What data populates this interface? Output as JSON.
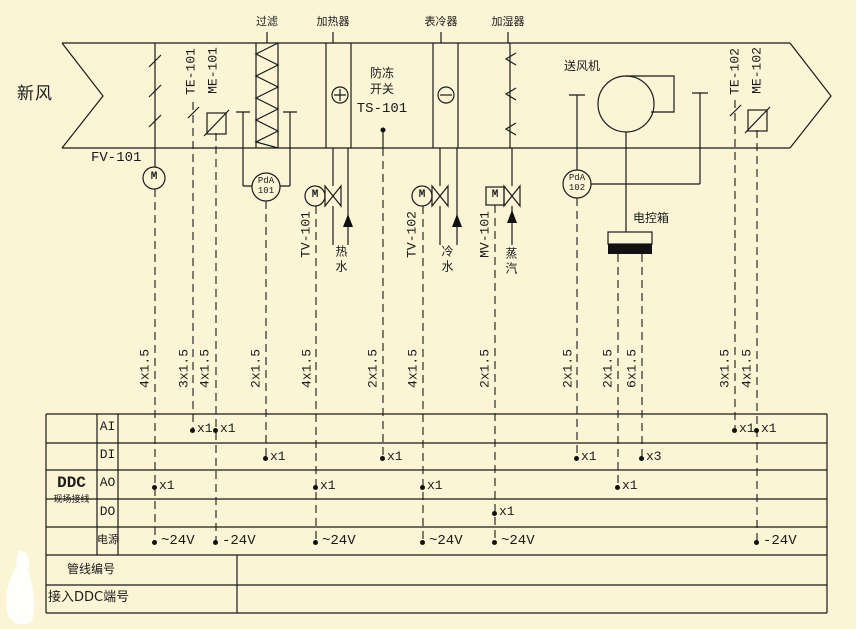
{
  "colors": {
    "background": "#FBF5D6",
    "ink": "#1b1b1b",
    "box_fill": "#111111",
    "blob": "#FEFEFB"
  },
  "duct": {
    "inlet_label": "新风",
    "fan_label": "送风机",
    "sections": [
      {
        "label": "过滤",
        "x": 267
      },
      {
        "label": "加热器",
        "x": 333
      },
      {
        "label": "表冷器",
        "x": 441
      },
      {
        "label": "加湿器",
        "x": 508
      }
    ]
  },
  "devices": {
    "damper_label": "FV-101",
    "control_box_label": "电控箱",
    "freeze_stat": {
      "line1": "防冻",
      "line2": "开关",
      "line3": "TS-101"
    },
    "pda_gauges": [
      {
        "line1": "PdA",
        "line2": "101",
        "x": 266,
        "y": 187
      },
      {
        "line1": "PdA",
        "line2": "102",
        "x": 577,
        "y": 184
      }
    ],
    "motors": [
      {
        "label": "M",
        "x": 154,
        "y": 178
      },
      {
        "label": "M",
        "x": 315,
        "y": 196
      },
      {
        "label": "M",
        "x": 422,
        "y": 196
      },
      {
        "label": "M",
        "x": 495,
        "y": 196
      }
    ],
    "vertical_tags": [
      {
        "label": "TE-101",
        "x": 192,
        "y": 72
      },
      {
        "label": "ME-101",
        "x": 214,
        "y": 71
      },
      {
        "label": "TV-101",
        "x": 307,
        "y": 235
      },
      {
        "label": "TV-102",
        "x": 413,
        "y": 235
      },
      {
        "label": "MV-101",
        "x": 486,
        "y": 235
      },
      {
        "label": "TE-102",
        "x": 736,
        "y": 72
      },
      {
        "label": "ME-102",
        "x": 758,
        "y": 71
      }
    ],
    "pipe_media": [
      {
        "label": "热水",
        "x": 338,
        "y": 270
      },
      {
        "label": "冷水",
        "x": 444,
        "y": 270
      },
      {
        "label": "蒸汽",
        "x": 508,
        "y": 272
      }
    ]
  },
  "cables": [
    {
      "label": "4x1.5",
      "x": 146
    },
    {
      "label": "3x1.5",
      "x": 185
    },
    {
      "label": "4x1.5",
      "x": 206
    },
    {
      "label": "2x1.5",
      "x": 257
    },
    {
      "label": "4x1.5",
      "x": 308
    },
    {
      "label": "2x1.5",
      "x": 374
    },
    {
      "label": "4x1.5",
      "x": 414
    },
    {
      "label": "2x1.5",
      "x": 486
    },
    {
      "label": "2x1.5",
      "x": 569
    },
    {
      "label": "2x1.5",
      "x": 609
    },
    {
      "label": "6x1.5",
      "x": 633
    },
    {
      "label": "3x1.5",
      "x": 726
    },
    {
      "label": "4x1.5",
      "x": 748
    }
  ],
  "table": {
    "group_label": "DDC",
    "group_sublabel": "现场接线",
    "row_labels": [
      "AI",
      "DI",
      "AO",
      "DO",
      "电源"
    ],
    "bottom_row_labels": [
      "管线编号",
      "接入DDC端号"
    ],
    "io_marks": [
      {
        "row": "AI",
        "x": 193,
        "label": "x1"
      },
      {
        "row": "AI",
        "x": 216,
        "label": "x1"
      },
      {
        "row": "AI",
        "x": 735,
        "label": "x1"
      },
      {
        "row": "AI",
        "x": 757,
        "label": "x1"
      },
      {
        "row": "DI",
        "x": 266,
        "label": "x1"
      },
      {
        "row": "DI",
        "x": 383,
        "label": "x1"
      },
      {
        "row": "DI",
        "x": 577,
        "label": "x1"
      },
      {
        "row": "DI",
        "x": 642,
        "label": "x3"
      },
      {
        "row": "AO",
        "x": 155,
        "label": "x1"
      },
      {
        "row": "AO",
        "x": 316,
        "label": "x1"
      },
      {
        "row": "AO",
        "x": 423,
        "label": "x1"
      },
      {
        "row": "AO",
        "x": 618,
        "label": "x1"
      },
      {
        "row": "DO",
        "x": 495,
        "label": "x1"
      }
    ],
    "power_marks": [
      {
        "x": 155,
        "label": "~24V"
      },
      {
        "x": 216,
        "label": "-24V"
      },
      {
        "x": 316,
        "label": "~24V"
      },
      {
        "x": 423,
        "label": "~24V"
      },
      {
        "x": 495,
        "label": "~24V"
      },
      {
        "x": 757,
        "label": "-24V"
      }
    ]
  }
}
